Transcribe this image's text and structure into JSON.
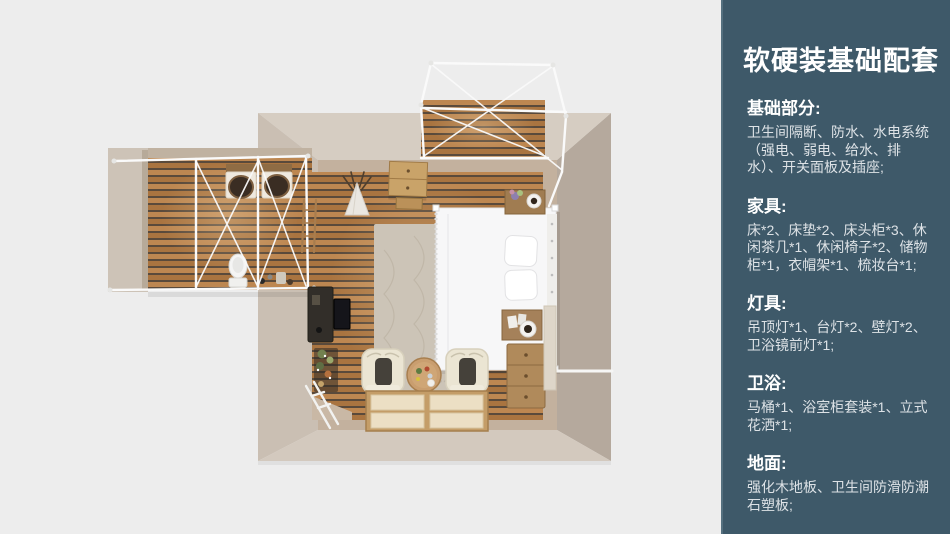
{
  "sidebar": {
    "title": "软硬装基础配套",
    "sections": [
      {
        "heading": "基础部分:",
        "body": "卫生间隔断、防水、水电系统（强电、弱电、给水、排水）、开关面板及插座;"
      },
      {
        "heading": "家具:",
        "body": "床*2、床垫*2、床头柜*3、休闲茶几*1、休闲椅子*2、储物柜*1，衣帽架*1、梳妆台*1;"
      },
      {
        "heading": "灯具:",
        "body": "吊顶灯*1、台灯*2、壁灯*2、卫浴镜前灯*1;"
      },
      {
        "heading": "卫浴:",
        "body": "马桶*1、浴室柜套装*1、立式花洒*1;"
      },
      {
        "heading": "地面:",
        "body": "强化木地板、卫生间防滑防潮石塑板;"
      }
    ],
    "colors": {
      "background": "#3e5969",
      "edge": "#55707f",
      "heading": "#ffffff",
      "body_text": "#dde2e6"
    }
  },
  "floorplan": {
    "view": "top-down 3d render of a glamping-style bedroom suite",
    "rooms": [
      "bedroom",
      "bathroom-annex",
      "porch-deck"
    ],
    "items": [
      "canopy-bed",
      "pillows",
      "rug",
      "armchair-left",
      "armchair-right",
      "coffee-table",
      "tatami-mats",
      "dresser",
      "nightstand-top",
      "nightstand-bottom",
      "desk",
      "tv",
      "plant-stand",
      "teepee-decor",
      "storage-cabinet",
      "ladder-shelf",
      "vanity-double-sink",
      "toilet",
      "bathroom-canopy-frame",
      "porch-canopy-frame"
    ],
    "colors": {
      "background": "#ededed",
      "wood_floor": "#b17b41",
      "wall_light": "#d6cdc2",
      "wall_side": "#cabfb3",
      "wall_dark": "#b5a99d",
      "wall_inner": "#c3b19e",
      "frame_white": "#fafafa"
    }
  }
}
